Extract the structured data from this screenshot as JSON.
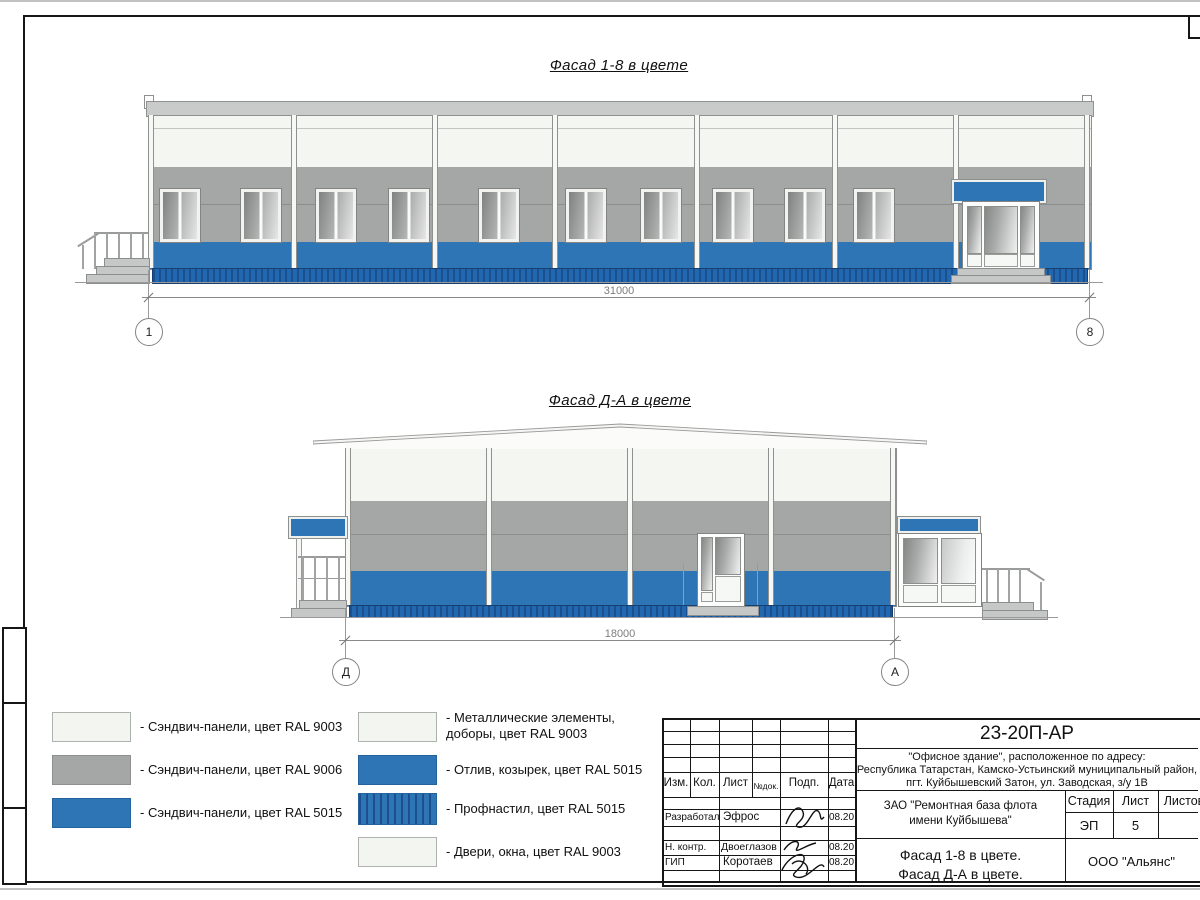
{
  "drawing1": {
    "title": "Фасад 1-8 в цвете",
    "dimension": "31000",
    "axis_left": "1",
    "axis_right": "8"
  },
  "drawing2": {
    "title": "Фасад Д-А в цвете",
    "dimension": "18000",
    "axis_left": "Д",
    "axis_right": "А"
  },
  "legend": {
    "left": [
      {
        "swatch": "white",
        "label": "- Сэндвич-панели, цвет RAL 9003"
      },
      {
        "swatch": "gray",
        "label": "- Сэндвич-панели, цвет RAL 9006"
      },
      {
        "swatch": "blue",
        "label": "- Сэндвич-панели, цвет RAL 5015"
      }
    ],
    "right": [
      {
        "swatch": "white",
        "label": "- Металлические элементы,\nдоборы, цвет RAL 9003"
      },
      {
        "swatch": "blue",
        "label": "- Отлив, козырек, цвет RAL 5015"
      },
      {
        "swatch": "blue-corrugated",
        "label": "- Профнастил, цвет RAL 5015"
      },
      {
        "swatch": "white",
        "label": "- Двери, окна, цвет RAL 9003"
      }
    ]
  },
  "colors": {
    "ral9003": "#f4f6f2",
    "ral9006": "#a5a7a6",
    "ral5015": "#2e75b6",
    "profnastil_dark": "#1c4f8e"
  },
  "titleblock": {
    "doc_number": "23-20П-АР",
    "address": "\"Офисное здание\", расположенное по адресу:\nРеспублика Татарстан, Камско-Устьинский муниципальный район,\nпгт. Куйбышевский Затон, ул. Заводская, з/у 1В",
    "columns": {
      "izm": "Изм.",
      "kol": "Кол.",
      "list": "Лист",
      "ndok": "№док.",
      "podp": "Подп.",
      "data": "Дата"
    },
    "rows": [
      {
        "role": "Разработал",
        "name": "Эфрос",
        "date": "08.20"
      },
      {
        "role": "Н. контр.",
        "name": "Двоеглазов",
        "date": "08.20"
      },
      {
        "role": "ГИП",
        "name": "Коротаев",
        "date": "08.20"
      }
    ],
    "client": "ЗАО \"Ремонтная база флота\nимени Куйбышева\"",
    "stage_label": "Стадия",
    "sheet_label": "Лист",
    "sheets_label": "Листов",
    "stage_value": "ЭП",
    "sheet_value": "5",
    "sheet_title": "Фасад 1-8 в цвете.\nФасад Д-А в цвете.",
    "company": "ООО \"Альянс\""
  }
}
